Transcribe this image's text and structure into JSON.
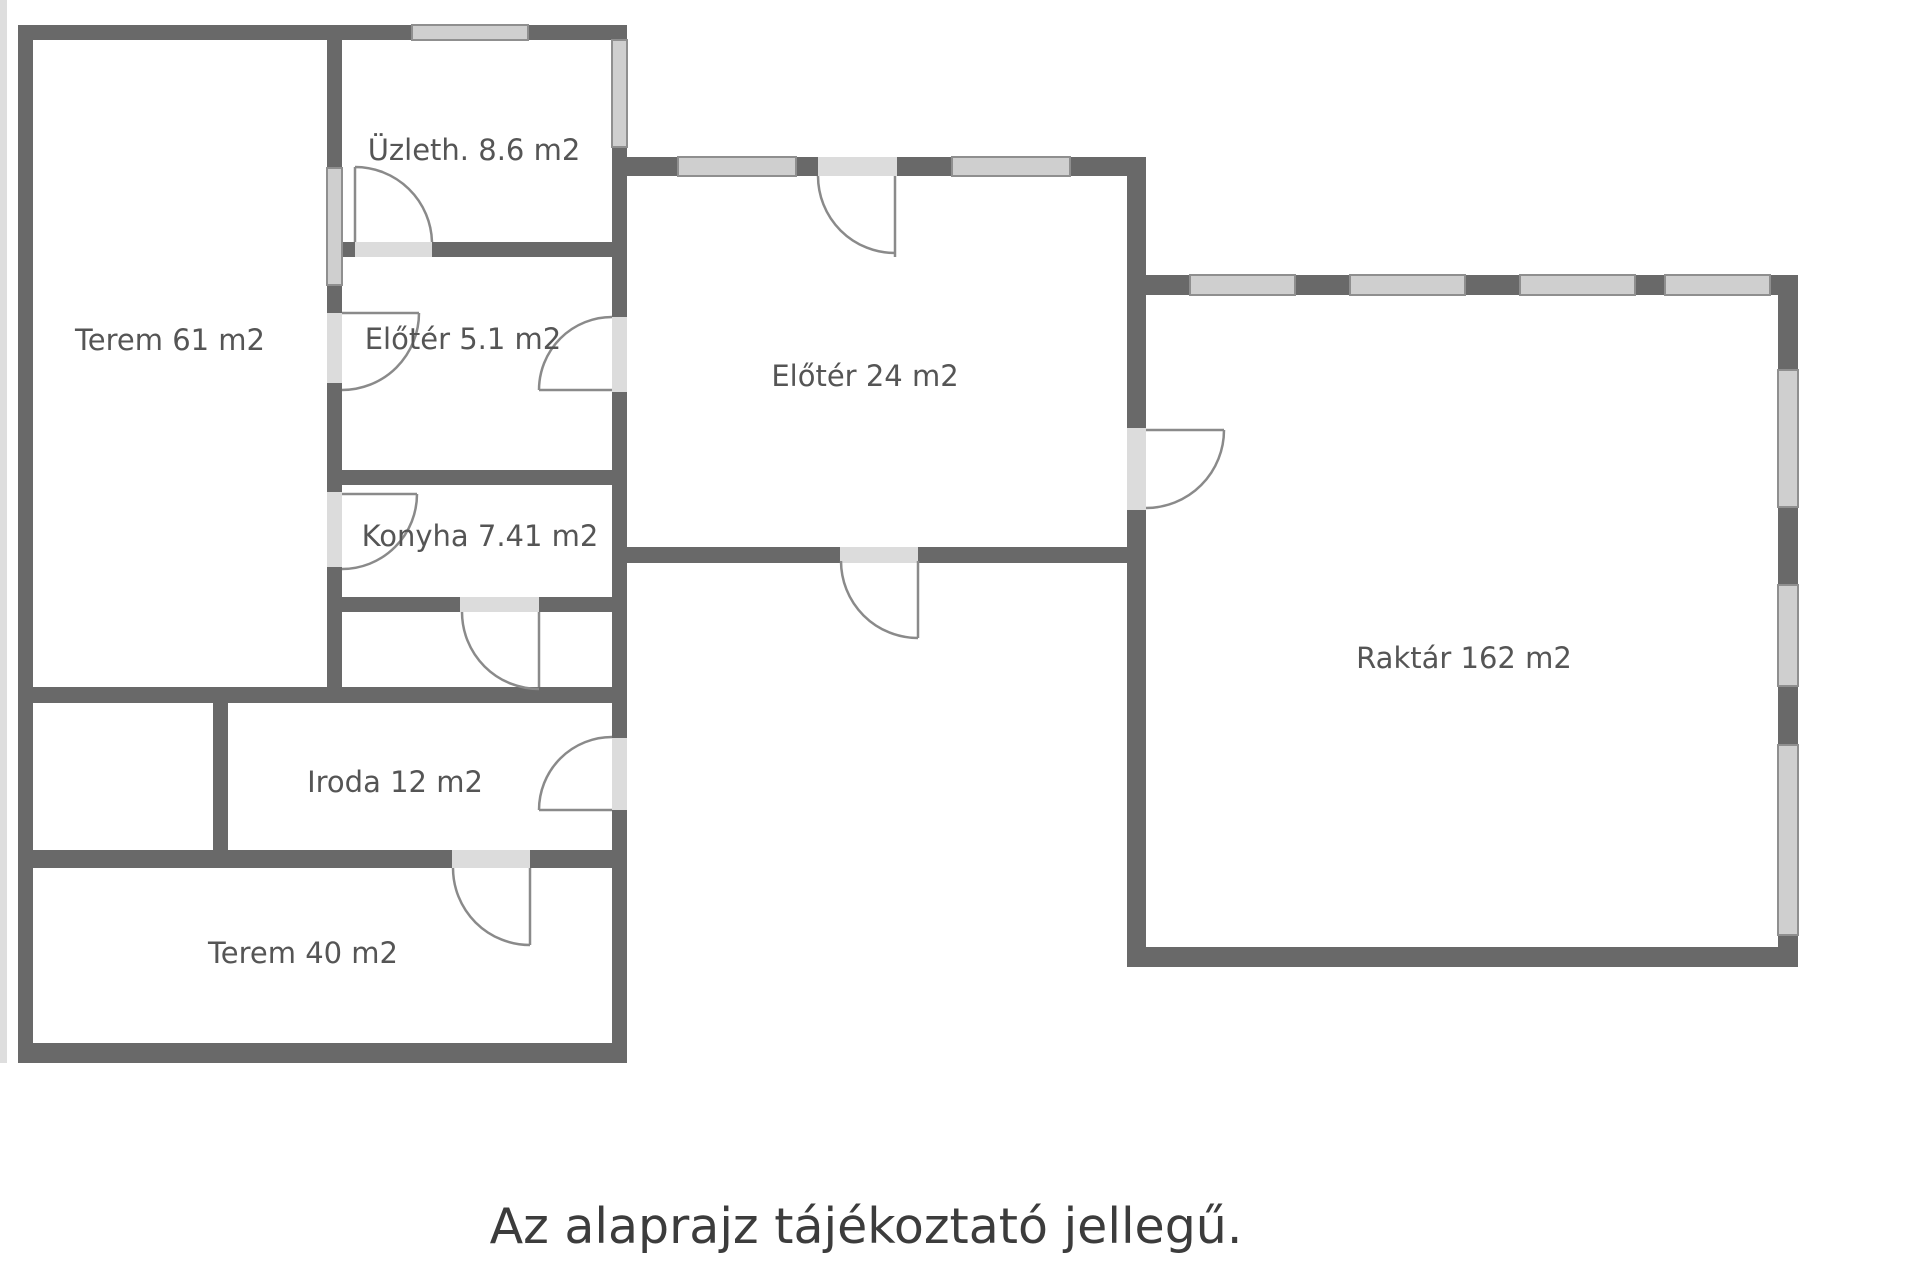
{
  "diagram": {
    "type": "floor-plan",
    "caption": "Az alaprajz tájékoztató jellegű.",
    "rooms": [
      {
        "id": "terem61",
        "label": "Terem 61 m2",
        "area_m2": "61"
      },
      {
        "id": "uzleth",
        "label": "Üzleth. 8.6 m2",
        "area_m2": "8.6"
      },
      {
        "id": "eloter51",
        "label": "Előtér 5.1 m2",
        "area_m2": "5.1"
      },
      {
        "id": "konyha",
        "label": "Konyha 7.41 m2",
        "area_m2": "7.41"
      },
      {
        "id": "eloter24",
        "label": "Előtér 24 m2",
        "area_m2": "24"
      },
      {
        "id": "raktar",
        "label": "Raktár 162 m2",
        "area_m2": "162"
      },
      {
        "id": "iroda",
        "label": "Iroda 12 m2",
        "area_m2": "12"
      },
      {
        "id": "terem40",
        "label": "Terem 40 m2",
        "area_m2": "40"
      }
    ],
    "colors": {
      "wall": "#696969",
      "window_fill": "#cfcfcf",
      "window_border": "#8f8f8f",
      "door_opening": "#dcdcdc",
      "door_arc": "#8a8a8a",
      "room_label": "#555555",
      "caption_text": "#3c3c3c",
      "background": "#ffffff"
    }
  }
}
